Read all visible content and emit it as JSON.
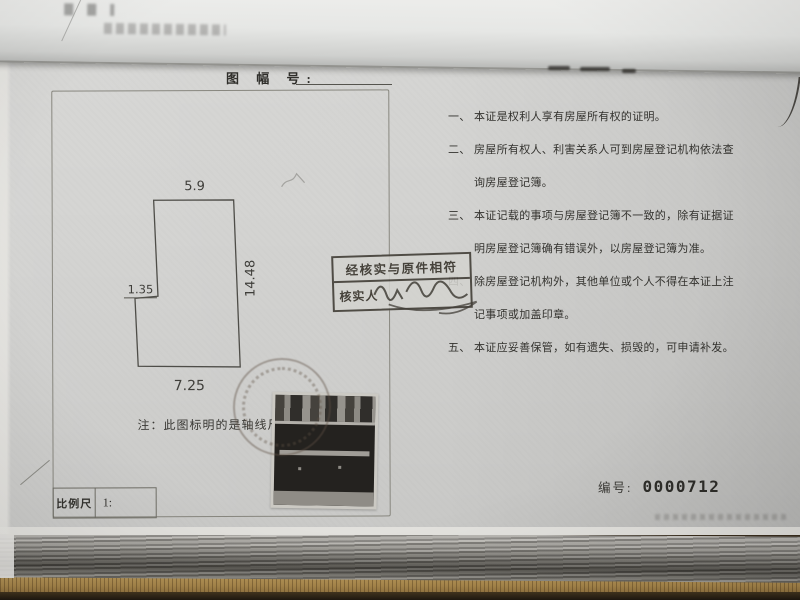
{
  "document": {
    "map_sheet_label": "图 幅 号:",
    "note": "注：此图标明的是轴线尺寸",
    "scale_label": "比例尺",
    "scale_value": "1:",
    "serial_label": "编号:",
    "serial_value": "0000712"
  },
  "floor_plan": {
    "dim_top": "5.9",
    "dim_right": "14.48",
    "dim_step": "1.35",
    "dim_bottom": "7.25"
  },
  "verification_stamp": {
    "line1": "经核实与原件相符",
    "line2_label": "核实人"
  },
  "clauses": {
    "lines": [
      {
        "num": "一、",
        "text": "本证是权利人享有房屋所有权的证明。"
      },
      {
        "num": "二、",
        "text": "房屋所有权人、利害关系人可到房屋登记机构依法查"
      },
      {
        "num": "",
        "text": "询房屋登记簿。"
      },
      {
        "num": "三、",
        "text": "本证记载的事项与房屋登记簿不一致的，除有证据证"
      },
      {
        "num": "",
        "text": "明房屋登记簿确有错误外，以房屋登记簿为准。"
      },
      {
        "num": "四、",
        "text": "除房屋登记机构外，其他单位或个人不得在本证上注"
      },
      {
        "num": "",
        "text": "记事项或加盖印章。"
      },
      {
        "num": "五、",
        "text": "本证应妥善保管，如有遗失、损毁的，可申请补发。"
      }
    ]
  },
  "colors": {
    "page": "#d3d3d1",
    "stamp_ink": "#45413a",
    "desk": "#a8874c",
    "text": "#33322e"
  }
}
